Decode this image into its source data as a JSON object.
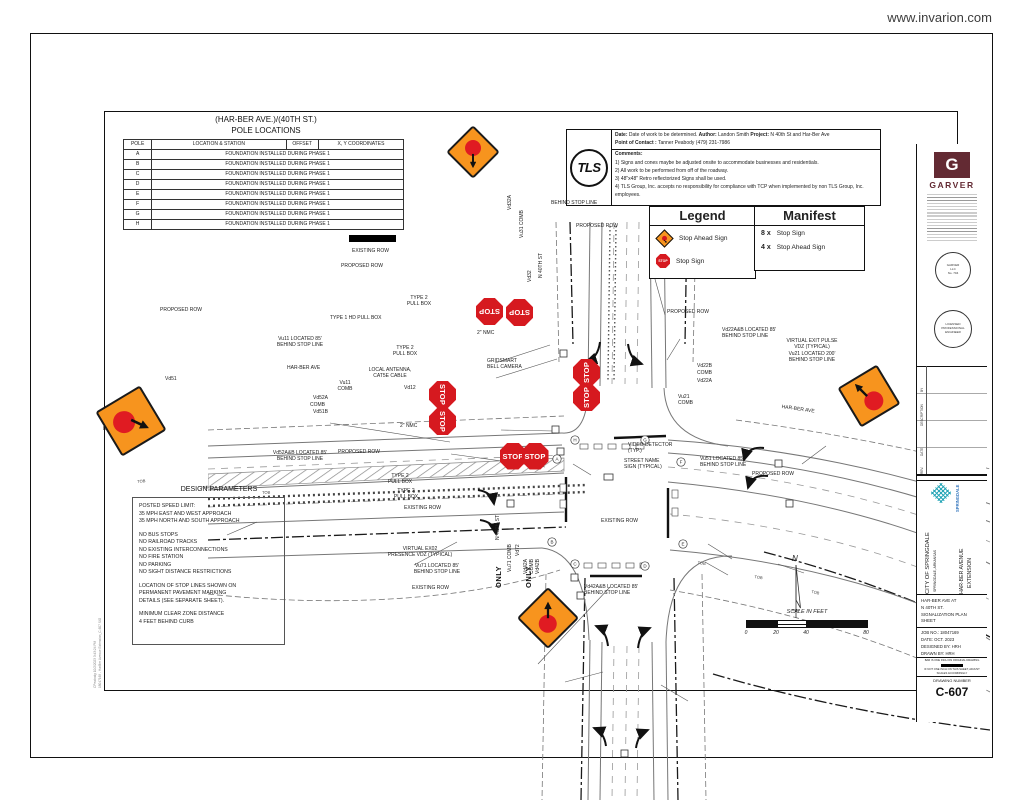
{
  "page": {
    "watermark": "www.invarion.com"
  },
  "pole_table": {
    "title_line1": "(HAR-BER AVE.)/(40TH ST.)",
    "title_line2": "POLE LOCATIONS",
    "headers": [
      "POLE",
      "LOCATION & STATION",
      "OFFSET",
      "X, Y COORDINATES"
    ],
    "rows": [
      {
        "pole": "A",
        "note": "FOUNDATION INSTALLED DURING PHASE 1"
      },
      {
        "pole": "B",
        "note": "FOUNDATION INSTALLED DURING PHASE 1"
      },
      {
        "pole": "C",
        "note": "FOUNDATION INSTALLED DURING PHASE 1"
      },
      {
        "pole": "D",
        "note": "FOUNDATION INSTALLED DURING PHASE 1"
      },
      {
        "pole": "E",
        "note": "FOUNDATION INSTALLED DURING PHASE 1"
      },
      {
        "pole": "F",
        "note": "FOUNDATION INSTALLED DURING PHASE 1"
      },
      {
        "pole": "G",
        "note": "FOUNDATION INSTALLED DURING PHASE 1"
      },
      {
        "pole": "H",
        "note": "FOUNDATION INSTALLED DURING PHASE 1"
      }
    ]
  },
  "info_box": {
    "logo": "TLS",
    "date_label": "Date:",
    "date_text": "Date of work to be determined.",
    "author_label": "Author:",
    "author_text": "Landon Smith",
    "project_label": "Project:",
    "project_text": "N 40th St and Har-Ber Ave",
    "contact_label": "Point of Contact :",
    "contact_text": "Tanner Peabody (479) 231-7986",
    "comments_label": "Comments:",
    "comments": [
      "1) Signs and cones maybe be adjusted onsite to accommodate businesses and residentials.",
      "2) All work to be performed from off of the roadway.",
      "3) 48\"x48\" Retro reflectorized Signs shall be used.",
      "4) TLS Group, Inc. accepts no responsibility for compliance with TCP when implemented by non TLS Group, Inc. employees."
    ]
  },
  "legend": {
    "title": "Legend",
    "items": [
      {
        "icon": "stop-ahead-sign-icon",
        "label": "Stop Ahead Sign"
      },
      {
        "icon": "stop-sign-icon",
        "label": "Stop Sign"
      }
    ]
  },
  "manifest": {
    "title": "Manifest",
    "items": [
      {
        "qty": "8 x",
        "label": "Stop Sign"
      },
      {
        "qty": "4 x",
        "label": "Stop Ahead Sign"
      }
    ]
  },
  "design_parameters": {
    "title": "DESIGN PARAMETERS",
    "lines": [
      "POSTED SPEED LIMIT:",
      "35 MPH EAST AND WEST APPROACH",
      "35 MPH NORTH AND SOUTH APPROACH",
      "",
      "NO BUS STOPS",
      "NO RAILROAD TRACKS",
      "NO EXISTING INTERCONNECTIONS",
      "NO FIRE STATION",
      "NO PARKING",
      "NO SIGHT DISTANCE RESTRICTIONS",
      "",
      "LOCATION OF STOP LINES SHOWN ON",
      "PERMANENT PAVEMENT MARKING",
      "DETAILS (SEE SEPARATE SHEET).",
      "",
      "MINIMUM CLEAR ZONE DISTANCE",
      "4 FEET BEHIND CURB"
    ]
  },
  "title_block": {
    "logo_letter": "G",
    "firm": "GARVER",
    "seal1_lines": [
      "GARVER",
      "LLC",
      "No. 704"
    ],
    "seal2_lines": [
      "LICENSED",
      "PROFESSIONAL",
      "ENGINEER"
    ],
    "rev_headers": [
      "BY",
      "DESCRIPTION",
      "DATE",
      "REV."
    ],
    "city_logo_name": "SPRINGDALE",
    "client_line1": "CITY OF SPRINGDALE",
    "client_line2": "SPRINGDALE, ARKANSAS",
    "project_line1": "HAR-BER AVENUE",
    "project_line2": "EXTENSION",
    "sheet_title": [
      "HAR-BER AVE AT",
      "N 40TH ST.",
      "SIGNALIZATION PLAN",
      "SHEET"
    ],
    "job_no": "JOB NO.: 18047169",
    "date": "DATE: OCT. 2023",
    "designed": "DESIGNED BY: HRH",
    "drawn": "DRAWN BY: HRH",
    "bar_note_1": "BAR IS ONE INCH ON ORIGINAL DRAWING",
    "bar_note_2": "IF NOT ONE INCH ON THIS SHEET, ADJUST SCALES ACCORDINGLY",
    "drawing_number_label": "DRAWING NUMBER",
    "drawing_number": "C-607"
  },
  "compass": {
    "label": "N"
  },
  "scale_bar": {
    "title": "SCALE  IN  FEET",
    "ticks": [
      {
        "label": "0",
        "f": 0
      },
      {
        "label": "20",
        "f": 0.25
      },
      {
        "label": "40",
        "f": 0.5
      },
      {
        "label": "80",
        "f": 1
      }
    ]
  },
  "plot_stamp": {
    "line1": "CPeabody      10/2/2023      3:43:24 PM",
    "line2": "18047169 - HarBer Avenue Extension_C-607 SIG"
  },
  "plan": {
    "stop_sign_text": "STOP",
    "colors": {
      "sign_orange": "#f7941e",
      "sign_red": "#d6191f"
    },
    "stop_signs": [
      {
        "x": 489,
        "y": 311,
        "rot": 180
      },
      {
        "x": 519,
        "y": 312,
        "rot": 180
      },
      {
        "x": 442,
        "y": 394,
        "rot": 90
      },
      {
        "x": 442,
        "y": 421,
        "rot": 90
      },
      {
        "x": 586,
        "y": 372,
        "rot": -90
      },
      {
        "x": 586,
        "y": 397,
        "rot": -90
      },
      {
        "x": 513,
        "y": 456,
        "rot": 0
      },
      {
        "x": 535,
        "y": 456,
        "rot": 0
      }
    ],
    "stop_ahead_signs": [
      {
        "x": 473,
        "y": 152,
        "s": 38,
        "tilt": 0,
        "cdx": 0,
        "cdy": -4,
        "adx": 0,
        "ady": 9,
        "arot": 90
      },
      {
        "x": 131,
        "y": 421,
        "s": 52,
        "tilt": 14,
        "cdx": -7,
        "cdy": 1,
        "adx": 9,
        "ady": 3,
        "arot": 25
      },
      {
        "x": 869,
        "y": 396,
        "s": 46,
        "tilt": 14,
        "cdx": 5,
        "cdy": 5,
        "adx": -8,
        "ady": -6,
        "arot": -135
      },
      {
        "x": 548,
        "y": 618,
        "s": 44,
        "tilt": 0,
        "cdx": 0,
        "cdy": 6,
        "adx": 0,
        "ady": -8,
        "arot": -90
      }
    ],
    "annotations": [
      {
        "t": "EXISTING ROW",
        "x": 352,
        "y": 248
      },
      {
        "t": "PROPOSED ROW",
        "x": 341,
        "y": 263
      },
      {
        "t": "BEHIND STOP LINE",
        "x": 551,
        "y": 200
      },
      {
        "t": "PROPOSED ROW",
        "x": 576,
        "y": 223
      },
      {
        "t": "PROPOSED ROW",
        "x": 160,
        "y": 307
      },
      {
        "t": "TYPE 1 HD PULL BOX",
        "x": 330,
        "y": 315
      },
      {
        "t": "TYPE 2\nPULL BOX",
        "x": 419,
        "y": 295,
        "c": 1
      },
      {
        "t": "Vu11 LOCATED 85'\nBEHIND STOP LINE",
        "x": 300,
        "y": 336,
        "c": 1
      },
      {
        "t": "TYPE 2\nPULL BOX",
        "x": 405,
        "y": 345,
        "c": 1
      },
      {
        "t": "HAR-BER AVE",
        "x": 287,
        "y": 365
      },
      {
        "t": "LOCAL ANTENNA,\nCAT5E CABLE",
        "x": 390,
        "y": 367,
        "c": 1
      },
      {
        "t": "Vd51",
        "x": 165,
        "y": 376
      },
      {
        "t": "Vu11\nCOMB",
        "x": 345,
        "y": 380,
        "c": 1
      },
      {
        "t": "Vd12",
        "x": 404,
        "y": 385
      },
      {
        "t": "Vd52A",
        "x": 313,
        "y": 395
      },
      {
        "t": "COMB",
        "x": 310,
        "y": 402
      },
      {
        "t": "Vd51B",
        "x": 313,
        "y": 409
      },
      {
        "t": "2\" NMC",
        "x": 400,
        "y": 423
      },
      {
        "t": "Vd51 L\nBEHIND",
        "x": 103,
        "y": 420
      },
      {
        "t": "Vd52A&B LOCATED 85'\nBEHIND STOP LINE",
        "x": 300,
        "y": 450,
        "c": 1
      },
      {
        "t": "PROPOSED ROW",
        "x": 338,
        "y": 449
      },
      {
        "t": "TYPE 2\nPULL BOX",
        "x": 400,
        "y": 473,
        "c": 1
      },
      {
        "t": "TYPE 2\nPULL BOX",
        "x": 406,
        "y": 488,
        "c": 1
      },
      {
        "t": "EXISTING ROW",
        "x": 404,
        "y": 505
      },
      {
        "t": "EXISTING ROW",
        "x": 601,
        "y": 518
      },
      {
        "t": "VIRTUAL EX02\nPRESENCE VDZ (TYPICAL)",
        "x": 420,
        "y": 546,
        "c": 1
      },
      {
        "t": "Vu71 LOCATED 85'\nBEHIND STOP LINE",
        "x": 437,
        "y": 563,
        "c": 1
      },
      {
        "t": "EXISTING ROW",
        "x": 412,
        "y": 585
      },
      {
        "t": "Vd42A&B LOCATED 85'\nBEHIND STOP LINE",
        "x": 584,
        "y": 584
      },
      {
        "t": "PROPOSED ROW",
        "x": 667,
        "y": 309
      },
      {
        "t": "Vd22A&B LOCATED 85'\nBEHIND STOP LINE",
        "x": 722,
        "y": 327
      },
      {
        "t": "VIRTUAL EXIT PULSE\nVDZ (TYPICAL)\nVu21 LOCATED 200'\nBEHIND STOP LINE",
        "x": 812,
        "y": 338,
        "c": 1
      },
      {
        "t": "HAR-BER AVE",
        "x": 782,
        "y": 404,
        "rot": 8
      },
      {
        "t": "Vd22B",
        "x": 697,
        "y": 363
      },
      {
        "t": "COMB",
        "x": 697,
        "y": 370
      },
      {
        "t": "Vd22A",
        "x": 697,
        "y": 378
      },
      {
        "t": "Vu21\nCOMB",
        "x": 678,
        "y": 394
      },
      {
        "t": "VIDEO DETECTOR\n(TYP.)",
        "x": 628,
        "y": 442
      },
      {
        "t": "STREET NAME\nSIGN (TYPICAL)",
        "x": 624,
        "y": 458
      },
      {
        "t": "Vu51 LOCATED 85'\nBEHIND STOP LINE",
        "x": 700,
        "y": 456
      },
      {
        "t": "PROPOSED ROW",
        "x": 752,
        "y": 471
      },
      {
        "t": "GRIDSMART\nBELL CAMERA",
        "x": 487,
        "y": 358
      },
      {
        "t": "2\" NMC",
        "x": 477,
        "y": 330
      },
      {
        "t": "Vd32A",
        "x": 507,
        "y": 210,
        "rot": -90
      },
      {
        "t": "Vu31 COMB",
        "x": 519,
        "y": 238,
        "rot": -90
      },
      {
        "t": "Vd32",
        "x": 527,
        "y": 282,
        "rot": -90
      },
      {
        "t": "N 40TH ST",
        "x": 538,
        "y": 278,
        "rot": -90
      },
      {
        "t": "N 40TH ST",
        "x": 495,
        "y": 540,
        "rot": -90
      },
      {
        "t": "Vd72",
        "x": 515,
        "y": 556,
        "rot": -90
      },
      {
        "t": "Vu71 COMB",
        "x": 507,
        "y": 572,
        "rot": -90
      },
      {
        "t": "Vd42A",
        "x": 523,
        "y": 574,
        "rot": -90
      },
      {
        "t": "COMB",
        "x": 529,
        "y": 574,
        "rot": -90
      },
      {
        "t": "Vd42B",
        "x": 535,
        "y": 574,
        "rot": -90
      },
      {
        "t": "ONLY",
        "x": 494,
        "y": 588,
        "rot": -90,
        "cls": "pavement"
      },
      {
        "t": "ONLY",
        "x": 524,
        "y": 588,
        "rot": -90,
        "cls": "pavement"
      },
      {
        "t": "TOB",
        "x": 137,
        "y": 479,
        "rot": -6,
        "cls": "tob"
      },
      {
        "t": "TOB",
        "x": 200,
        "y": 485,
        "rot": -4,
        "cls": "tob"
      },
      {
        "t": "TOB",
        "x": 262,
        "y": 490,
        "rot": -2,
        "cls": "tob"
      },
      {
        "t": "TOB",
        "x": 698,
        "y": 560,
        "rot": 8,
        "cls": "tob"
      },
      {
        "t": "TOB",
        "x": 755,
        "y": 574,
        "rot": 10,
        "cls": "tob"
      },
      {
        "t": "TOB",
        "x": 812,
        "y": 589,
        "rot": 12,
        "cls": "tob"
      }
    ]
  }
}
